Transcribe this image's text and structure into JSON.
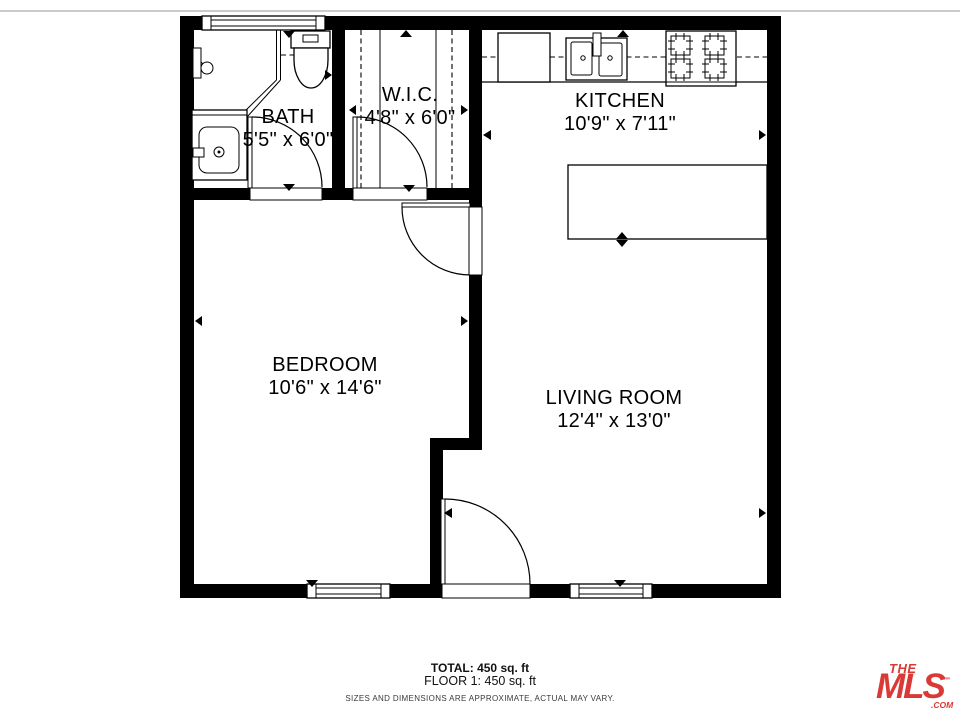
{
  "colors": {
    "walls": "#000000",
    "background": "#ffffff",
    "logo_red": "#d93a35",
    "top_border": "#cbcbcb"
  },
  "rooms": [
    {
      "name": "BATH",
      "dims": "5'5\" x 6'0\""
    },
    {
      "name": "W.I.C.",
      "dims": "4'8\" x 6'0\""
    },
    {
      "name": "KITCHEN",
      "dims": "10'9\" x 7'11\""
    },
    {
      "name": "BEDROOM",
      "dims": "10'6\" x 14'6\""
    },
    {
      "name": "LIVING ROOM",
      "dims": "12'4\" x 13'0\""
    }
  ],
  "footer": {
    "total": "TOTAL: 450 sq. ft",
    "floor": "FLOOR 1: 450 sq. ft",
    "disclaimer": "SIZES AND DIMENSIONS ARE APPROXIMATE, ACTUAL MAY VARY."
  },
  "logo": {
    "line1": "THE",
    "line2": "MLS",
    "suffix": ".COM",
    "trademark": "™",
    "style": "color:#d93a35"
  },
  "fixtures": [
    "shower",
    "toilet",
    "vanity-sink",
    "closet-rods",
    "refrigerator",
    "kitchen-sink",
    "stove",
    "kitchen-island"
  ]
}
